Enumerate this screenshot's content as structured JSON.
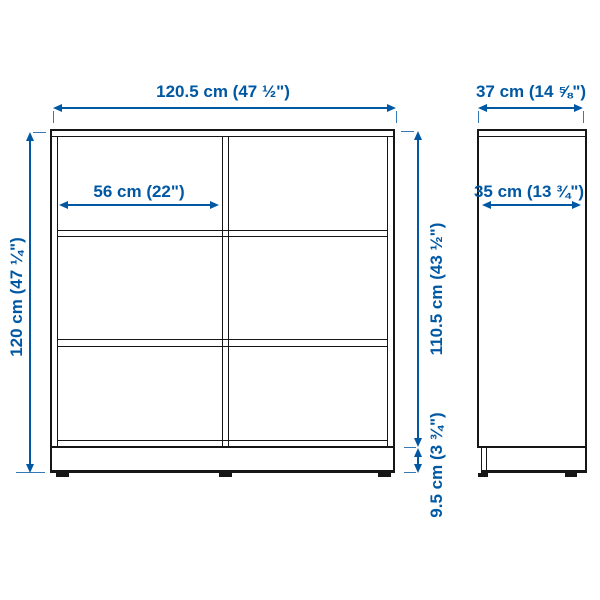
{
  "diagram": {
    "title": "storage unit dimension diagram",
    "colors": {
      "dimension_blue": "#0058a3",
      "outline_black": "#161616",
      "background": "#ffffff"
    },
    "front_view": {
      "description": "front elevation of 2x3 open shelving unit on plinth base",
      "columns": 2,
      "rows": 3,
      "width_label": "120.5 cm (47 ½\")",
      "height_label": "120 cm (47 ¼\")",
      "compartment_width_label": "56 cm (22\")",
      "interior_height_label": "110.5 cm (43 ½\")",
      "base_height_label": "9.5 cm (3 ¾\")"
    },
    "side_view": {
      "description": "side elevation of unit",
      "depth_label": "37 cm (14 ⅝\")",
      "interior_depth_label": "35 cm (13 ¾\")"
    }
  }
}
